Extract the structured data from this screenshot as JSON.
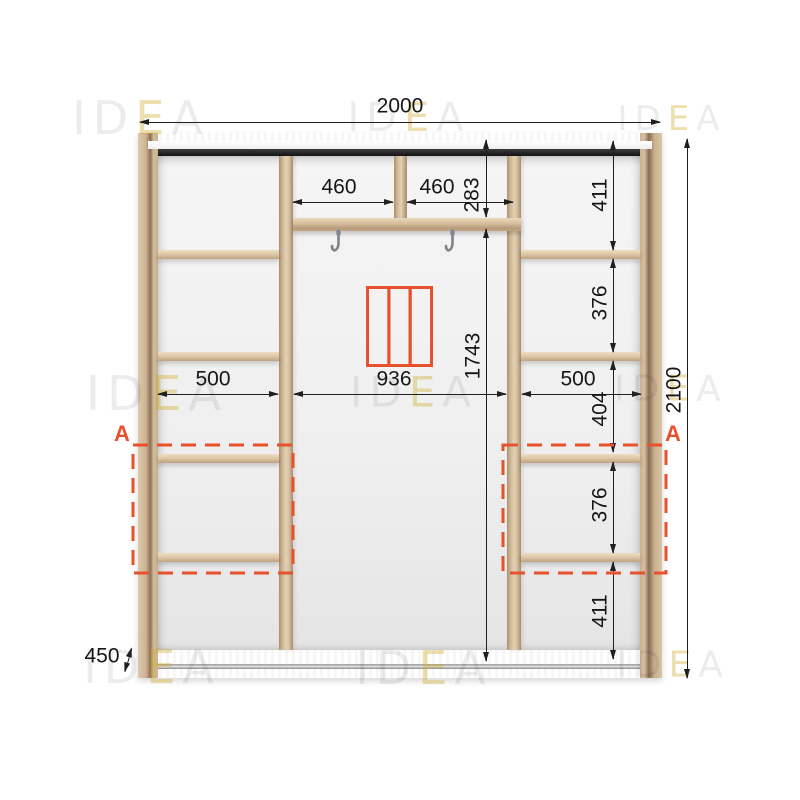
{
  "watermark": {
    "pre": "ID",
    "accent": "E",
    "post": "A"
  },
  "section_marker": "A",
  "dimensions": {
    "total_width": "2000",
    "total_height": "2100",
    "depth": "450",
    "top_left_compartment_width": "460",
    "top_right_compartment_width": "460",
    "top_compartment_height": "283",
    "left_column_width": "500",
    "center_section_width": "936",
    "right_column_width": "500",
    "center_section_height": "1743",
    "right_col_top_height": "411",
    "right_col_second_height": "376",
    "right_col_third_height": "404",
    "right_col_fourth_height": "376",
    "right_col_bottom_height": "411"
  },
  "colors": {
    "accent_orange": "#E8512D",
    "wood_light": "#DCC9AC",
    "wood_shadow": "#93775D",
    "track_dark": "#242424",
    "dimension_line": "#1F1F1F",
    "watermark_gray": "#E9E9E9",
    "watermark_yellow": "#F2E7AD"
  },
  "icons": {
    "sliding_door_icon": "three-panel sliding door front",
    "rail_hook_icon": "clothes rail hook"
  }
}
